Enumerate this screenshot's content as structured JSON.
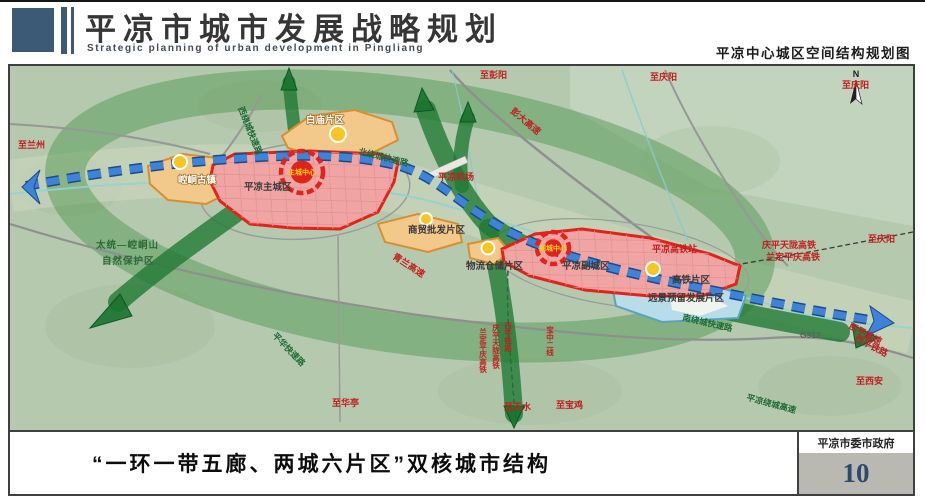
{
  "header": {
    "title_cn": "平凉市城市发展战略规划",
    "title_en": "Strategic planning of urban development in Pingliang",
    "map_title": "平凉中心城区空间结构规划图"
  },
  "footer": {
    "caption": "“一环一带五廊、两城六片区”双核城市结构",
    "organization": "平凉市委市政府",
    "page_number": "10"
  },
  "map": {
    "compass": "N",
    "cores": [
      {
        "name": "主城中心",
        "x": 292,
        "y": 106,
        "r": 21
      },
      {
        "name": "副城中心",
        "x": 543,
        "y": 182,
        "r": 16
      }
    ],
    "labels": [
      {
        "t": "至兰州",
        "x": 8,
        "y": 82,
        "c": "red"
      },
      {
        "t": "西绕城快速路",
        "x": 228,
        "y": 42,
        "c": "green",
        "r": 68
      },
      {
        "t": "北绕城快速路",
        "x": 348,
        "y": 88,
        "c": "green",
        "r": 14
      },
      {
        "t": "白庙片区",
        "x": 296,
        "y": 57,
        "c": "wlabel"
      },
      {
        "t": "彭大高速",
        "x": 500,
        "y": 46,
        "c": "red",
        "r": 40
      },
      {
        "t": "至彭阳",
        "x": 470,
        "y": 12,
        "c": "red"
      },
      {
        "t": "至庆阳",
        "x": 640,
        "y": 14,
        "c": "red"
      },
      {
        "t": "至庆阳",
        "x": 832,
        "y": 22,
        "c": "red"
      },
      {
        "t": "平凉机场",
        "x": 428,
        "y": 114,
        "c": "red"
      },
      {
        "t": "平凉主城区",
        "x": 234,
        "y": 124,
        "c": "dark"
      },
      {
        "t": "崆峒古镇",
        "x": 168,
        "y": 117,
        "c": "wlabel"
      },
      {
        "t": "太统—崆峒山",
        "x": 86,
        "y": 182,
        "c": "greens"
      },
      {
        "t": "自然保护区",
        "x": 92,
        "y": 198,
        "c": "greens"
      },
      {
        "t": "青兰高速",
        "x": 382,
        "y": 192,
        "c": "red",
        "r": 33
      },
      {
        "t": "商贸批发片区",
        "x": 398,
        "y": 167,
        "c": "dark"
      },
      {
        "t": "物流仓储片区",
        "x": 456,
        "y": 203,
        "c": "dark"
      },
      {
        "t": "平凉副城区",
        "x": 552,
        "y": 203,
        "c": "dark"
      },
      {
        "t": "平凉高铁站",
        "x": 642,
        "y": 186,
        "c": "red"
      },
      {
        "t": "庆平天陇高铁",
        "x": 752,
        "y": 182,
        "c": "red"
      },
      {
        "t": "兰定平庆高铁",
        "x": 756,
        "y": 194,
        "c": "red"
      },
      {
        "t": "至庆阳",
        "x": 858,
        "y": 176,
        "c": "red"
      },
      {
        "t": "高铁片区",
        "x": 662,
        "y": 217,
        "c": "dark"
      },
      {
        "t": "远景预留发展片区",
        "x": 638,
        "y": 235,
        "c": "dark"
      },
      {
        "t": "南绕城快速路",
        "x": 672,
        "y": 254,
        "c": "green",
        "r": 13
      },
      {
        "t": "G312",
        "x": 790,
        "y": 272,
        "c": "gray"
      },
      {
        "t": "西平高速",
        "x": 838,
        "y": 262,
        "c": "red",
        "r": 28
      },
      {
        "t": "西平铁路",
        "x": 844,
        "y": 274,
        "c": "red",
        "r": 28
      },
      {
        "t": "至西安",
        "x": 846,
        "y": 318,
        "c": "red"
      },
      {
        "t": "平凉绕城高速",
        "x": 736,
        "y": 334,
        "c": "green",
        "r": 15
      },
      {
        "t": "平华快速路",
        "x": 262,
        "y": 270,
        "c": "green",
        "r": 46
      },
      {
        "t": "至华亭",
        "x": 322,
        "y": 340,
        "c": "red"
      },
      {
        "t": "至天水",
        "x": 494,
        "y": 344,
        "c": "red"
      },
      {
        "t": "至宝鸡",
        "x": 546,
        "y": 342,
        "c": "red"
      },
      {
        "t": "宝中二线",
        "x": 540,
        "y": 260,
        "c": "vred"
      },
      {
        "t": "西平铁路",
        "x": 498,
        "y": 256,
        "c": "vred"
      },
      {
        "t": "庆平天陇高铁",
        "x": 486,
        "y": 258,
        "c": "vred"
      },
      {
        "t": "兰定平庆高铁",
        "x": 473,
        "y": 262,
        "c": "vred"
      }
    ]
  },
  "colors": {
    "brand_navy": "#3c5a76",
    "core_red": "#e0231c",
    "axis_blue": "#3f83d9",
    "corridor_green": "#1e7a34",
    "district_orange": "#f3c98b",
    "city_pink": "#f0a4a4",
    "reserve_blue": "#b9dcea",
    "pagenum_bg": "#b9b9b1"
  }
}
